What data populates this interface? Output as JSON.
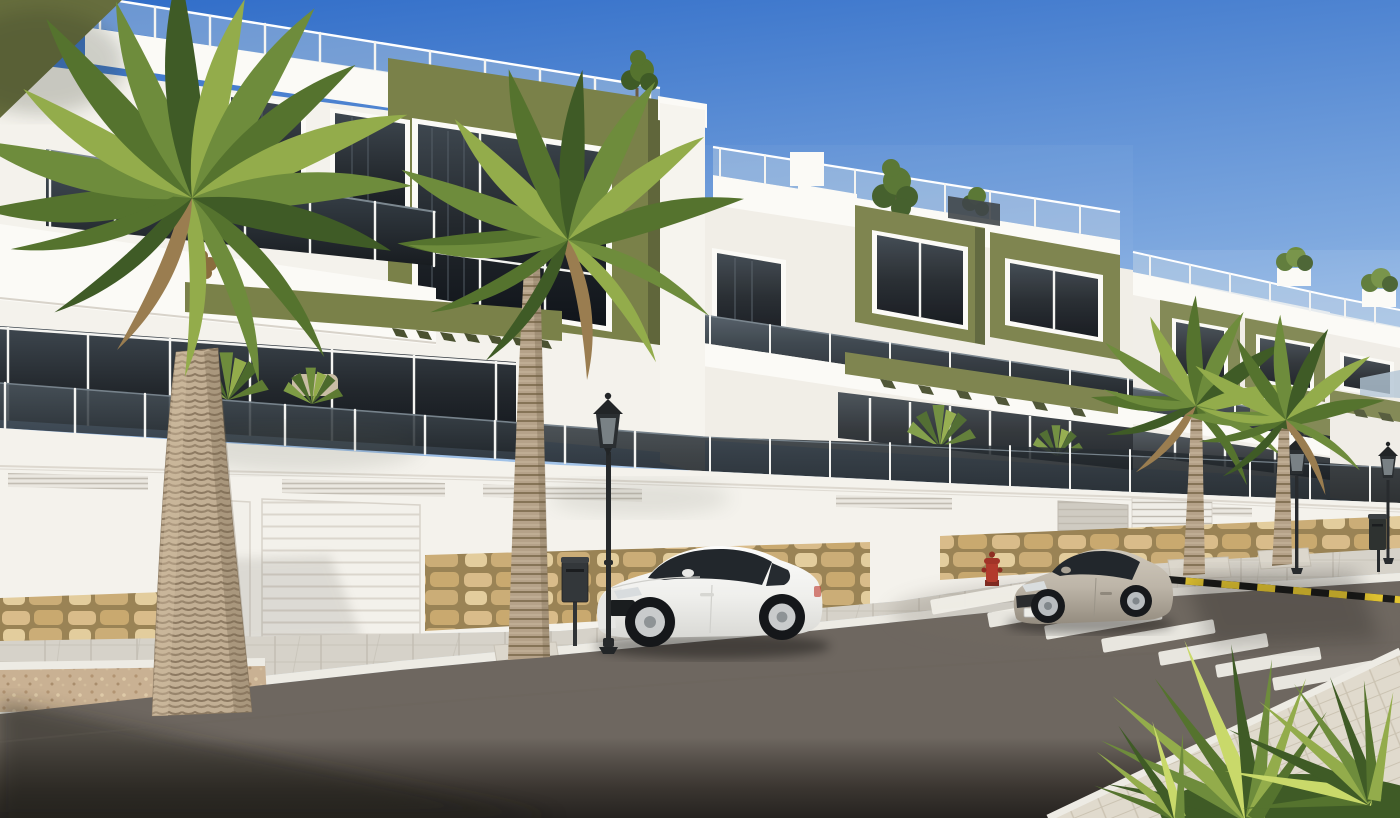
{
  "scene": {
    "title": "New-build apartment complex — sunny street view render",
    "description": "Sunny 3D architectural render of a modern white apartment complex with olive-green accent volumes, dark glass balcony balustrades and rooftop glass railings, receding along a street. In front: a white street wall with garage doors and natural stone base, a paved sidewalk with tall palm trees, a parked white coupe and a silver coupe, a zebra crosswalk, a yellow-and-black curb marking, classic lantern street lamps, a red fire hydrant, litter bins and a spiky fan-palm bush in the lower right corner under a clear blue gradient sky.",
    "objects": [
      "apartment-building-row",
      "rooftop-glass-railings",
      "olive-accent-volumes",
      "balcony-glass-balustrades",
      "white-balcony-slabs",
      "olive-pergola-bands",
      "street-wall-with-garage-doors",
      "stone-cladding-base",
      "sidewalk-pavers",
      "planter-with-gravel",
      "palm-tree-left",
      "palm-tree-center",
      "palm-trees-right",
      "fan-palm-bush",
      "white-coupe-car",
      "silver-coupe-car",
      "asphalt-road",
      "zebra-crosswalk",
      "yellow-black-hazard-marking",
      "street-lamp-classic",
      "litter-bins",
      "fire-hydrant",
      "rooftop-trees",
      "distant-hill"
    ],
    "counts": {
      "buildings_visible": 4,
      "cars": 2,
      "large_palms": 4,
      "street_lamps": 3,
      "bins": 2,
      "crosswalk_stripes": 7
    }
  },
  "palette": {
    "sky_top": "#2F6CC8",
    "sky_mid": "#7FA9DF",
    "sky_low": "#C9DFF2",
    "sky_horizon": "#EDF4FB",
    "wall_white": "#F4F2EC",
    "wall_dim": "#EDEAE2",
    "wall_shade": "#E0DCD4",
    "slab_white": "#FBFAF6",
    "olive": "#7A8149",
    "olive_dark": "#666D3D",
    "olive_deep": "#4A5130",
    "glass_mid": "#3E474F",
    "glass_dark": "#23282D",
    "glass_deep": "#10141A",
    "rail_post": "#F4F4F1",
    "rail_glass": "#C3D5E2",
    "stone_grout": "#9A8355",
    "stone_a": "#D9BC8A",
    "stone_b": "#C9A96F",
    "stone_c": "#E3CD9D",
    "stone_d": "#CBAD77",
    "sidewalk": "#D6D2C9",
    "sidewalk_joint": "#C2BDB2",
    "sidewalk_right": "#E0DACD",
    "curb": "#EDEBE4",
    "road_1": "#6E6760",
    "road_2": "#544E48",
    "road_3": "#3B3631",
    "road_4": "#262320",
    "zebra": "#F2F0E9",
    "mark_yellow": "#E2C431",
    "mark_black": "#1B1B19",
    "car_white": "#F5F5F3",
    "car_white_dk": "#D9D9D5",
    "car_glass": "#22272C",
    "car_silver": "#BDB5A8",
    "car_silver_dk": "#948C7F",
    "metal": "#282B2E",
    "hydrant_red": "#B23A2C",
    "green_1": "#6E8C3C",
    "green_2": "#55732E",
    "green_3": "#93AC4B",
    "green_4": "#3F5B26",
    "green_dead": "#9A7D50",
    "green_hi": "#C9D96A",
    "trunk_a": "#C2AF94",
    "trunk_b": "#B5A289",
    "trunk_ring": "#8D7A62",
    "gravel": "#C9B193",
    "hill": "#AEC2D2",
    "shadow_warm": "#5A5E52"
  }
}
